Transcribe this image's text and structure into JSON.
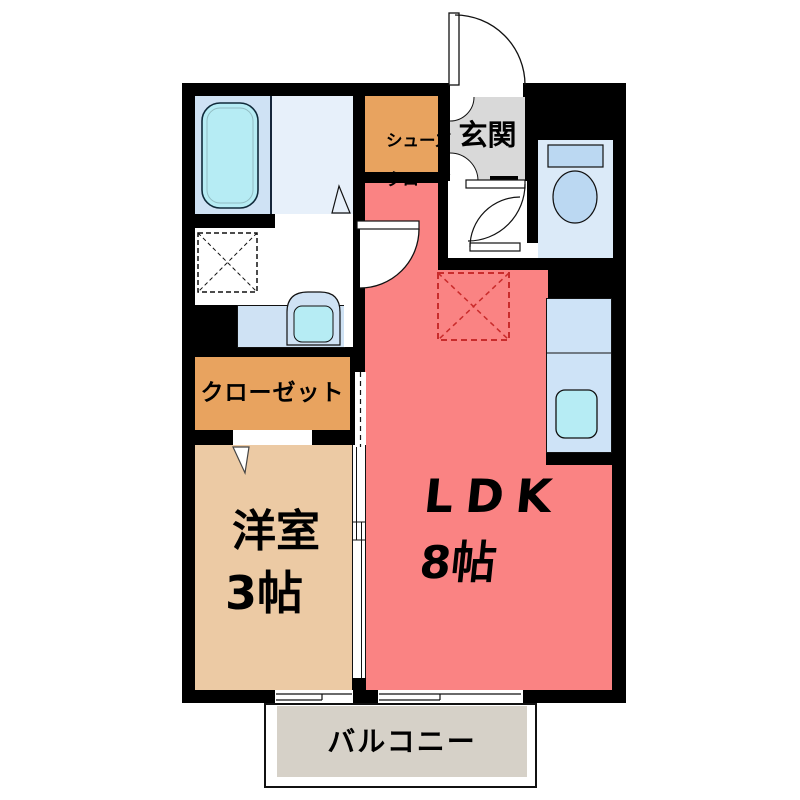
{
  "rooms": {
    "shoe_closet": {
      "line1": "シューズ",
      "line2": "クローク"
    },
    "entrance": {
      "label": "玄関"
    },
    "closet": {
      "label": "クローゼット"
    },
    "western_room": {
      "name": "洋室",
      "size": "3帖"
    },
    "ldk": {
      "name": "LDK",
      "size": "8帖"
    },
    "balcony": {
      "label": "バルコニー"
    }
  },
  "colors": {
    "wall": "#000000",
    "ldk_pink": "#FA8383",
    "room_tan": "#ECCAA4",
    "closet_orange": "#E8A35F",
    "entrance_gray": "#D9D9D9",
    "balcony_gray": "#D6D1C8",
    "bath_blue": "#CFE2F4",
    "bath_light": "#E7F0FA",
    "toilet_room_blue": "#DBEAF8",
    "counter_blue": "#CEE3F7",
    "fixture_blue": "#BBD8F2",
    "water_cyan": "#B6ECF4",
    "fridge_red": "#C92B2B"
  }
}
